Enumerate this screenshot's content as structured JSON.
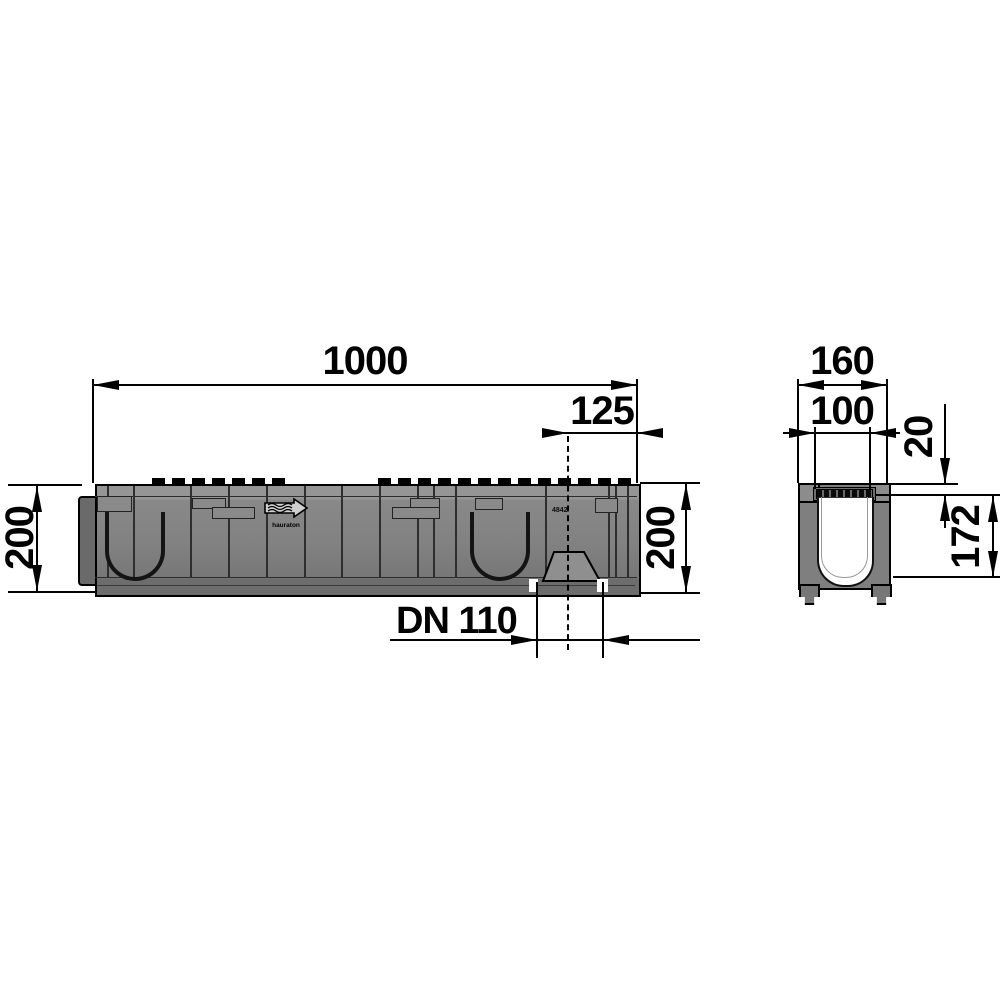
{
  "drawing": {
    "type": "technical-drawing",
    "subject": "drainage channel with bottom outlet - side elevation and cross section",
    "dimensions": {
      "length": "1000",
      "outlet_offset": "125",
      "height_left": "200",
      "height_right": "200",
      "outlet_diameter": "DN 110",
      "section_outer_width": "160",
      "section_inner_width": "100",
      "rim_depth": "20",
      "section_inner_depth": "172"
    },
    "side_view": {
      "logo_text": "hauraton",
      "part_number": "4842"
    },
    "colors": {
      "line": "#000000",
      "body_gray": "#7f7f7f",
      "background": "#ffffff"
    }
  }
}
